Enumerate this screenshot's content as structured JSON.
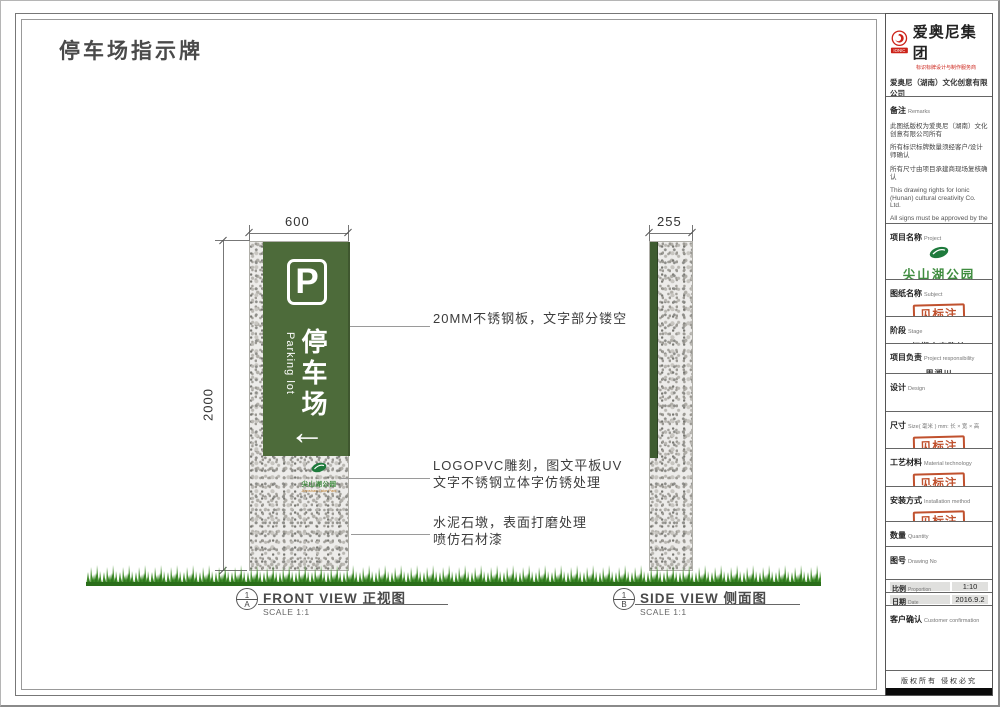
{
  "page": {
    "title": "停车场指示牌"
  },
  "company": {
    "logo_text": "IONIC",
    "group_name": "爱奥尼集团",
    "tagline": "标识标牌设计与制作服务商",
    "company_name": "爱奥尼（湖南）文化创意有限公司",
    "address": "地址:长沙市桐树城西普惠国际2122室",
    "phone": "电话:0731-85074045",
    "website": "http://www.ionic.net.cn"
  },
  "tb": {
    "remarks": {
      "label": "备注",
      "label_en": "Remarks",
      "cn": [
        "此图纸版权为爱奥尼（湖南）文化创意有限公司所有",
        "所有标识标牌数量须经客户/设计师确认",
        "所有尺寸由项目承建商现场复核确认"
      ],
      "en": [
        "This drawing rights for Ionic (Hunan) cultural creativity Co. Ltd.",
        "All signs must be approved by the customer / designer to confirm the number of",
        "All dimensions by the project contractors on site review confirmed"
      ]
    },
    "project": {
      "label": "项目名称",
      "label_en": "Project",
      "park_name": "尖山湖公园",
      "park_en": "Jianshan Lake Park"
    },
    "subject": {
      "label": "图纸名称",
      "label_en": "Subject",
      "stamp": "见标注"
    },
    "stage": {
      "label": "阶段",
      "label_en": "Stage",
      "value": "初期方案确认"
    },
    "responsibility": {
      "label": "项目负责",
      "label_en": "Project responsibility",
      "value": "周湘川"
    },
    "design": {
      "label": "设计",
      "label_en": "Design"
    },
    "size": {
      "label": "尺寸",
      "label_en": "Size( 毫米 ) mm: 长 × 宽 × 高",
      "stamp": "见标注"
    },
    "material": {
      "label": "工艺材料",
      "label_en": "Material technology",
      "stamp": "见标注"
    },
    "installation": {
      "label": "安装方式",
      "label_en": "Installation method",
      "stamp": "见标注"
    },
    "quantity": {
      "label": "数量",
      "label_en": "Quantity"
    },
    "drawing_no": {
      "label": "图号",
      "label_en": "Drawing No"
    },
    "proportion": {
      "label": "比例",
      "label_en": "Proportion",
      "value": "1:10"
    },
    "date": {
      "label": "日期",
      "label_en": "Date",
      "value": "2016.9.2"
    },
    "confirmation": {
      "label": "客户确认",
      "label_en": "Customer confirmation"
    },
    "copyright": "版权所有  侵权必究"
  },
  "drawing": {
    "sign": {
      "p": "P",
      "cn": "停车场",
      "en": "Parking lot",
      "arrow": "←"
    },
    "pillar_logo": {
      "cn": "尖山湖公园",
      "en": "Jianshan Lake Park"
    },
    "dims": {
      "width": "600",
      "height": "2000",
      "side": "255"
    },
    "annotations": [
      {
        "lines": [
          "20MM不锈钢板，文字部分镂空"
        ]
      },
      {
        "lines": [
          "LOGOPVC雕刻，图文平板UV",
          "文字不锈钢立体字仿锈处理"
        ]
      },
      {
        "lines": [
          "水泥石墩，表面打磨处理",
          "喷仿石材漆"
        ]
      }
    ],
    "views": [
      {
        "num": "1",
        "letter": "A",
        "title": "FRONT VIEW 正视图",
        "scale": "SCALE 1:1"
      },
      {
        "num": "1",
        "letter": "B",
        "title": "SIDE VIEW 侧面图",
        "scale": "SCALE 1:1"
      }
    ]
  },
  "colors": {
    "panel_green": "#4d6b3a",
    "side_green": "#3e5c30",
    "stamp_red": "#c0512e",
    "logo_red": "#cc2218",
    "park_green": "#3f8c3f",
    "park_orange": "#c08030",
    "grass_green": "#3f8c28",
    "granite_base": "#edecea"
  }
}
